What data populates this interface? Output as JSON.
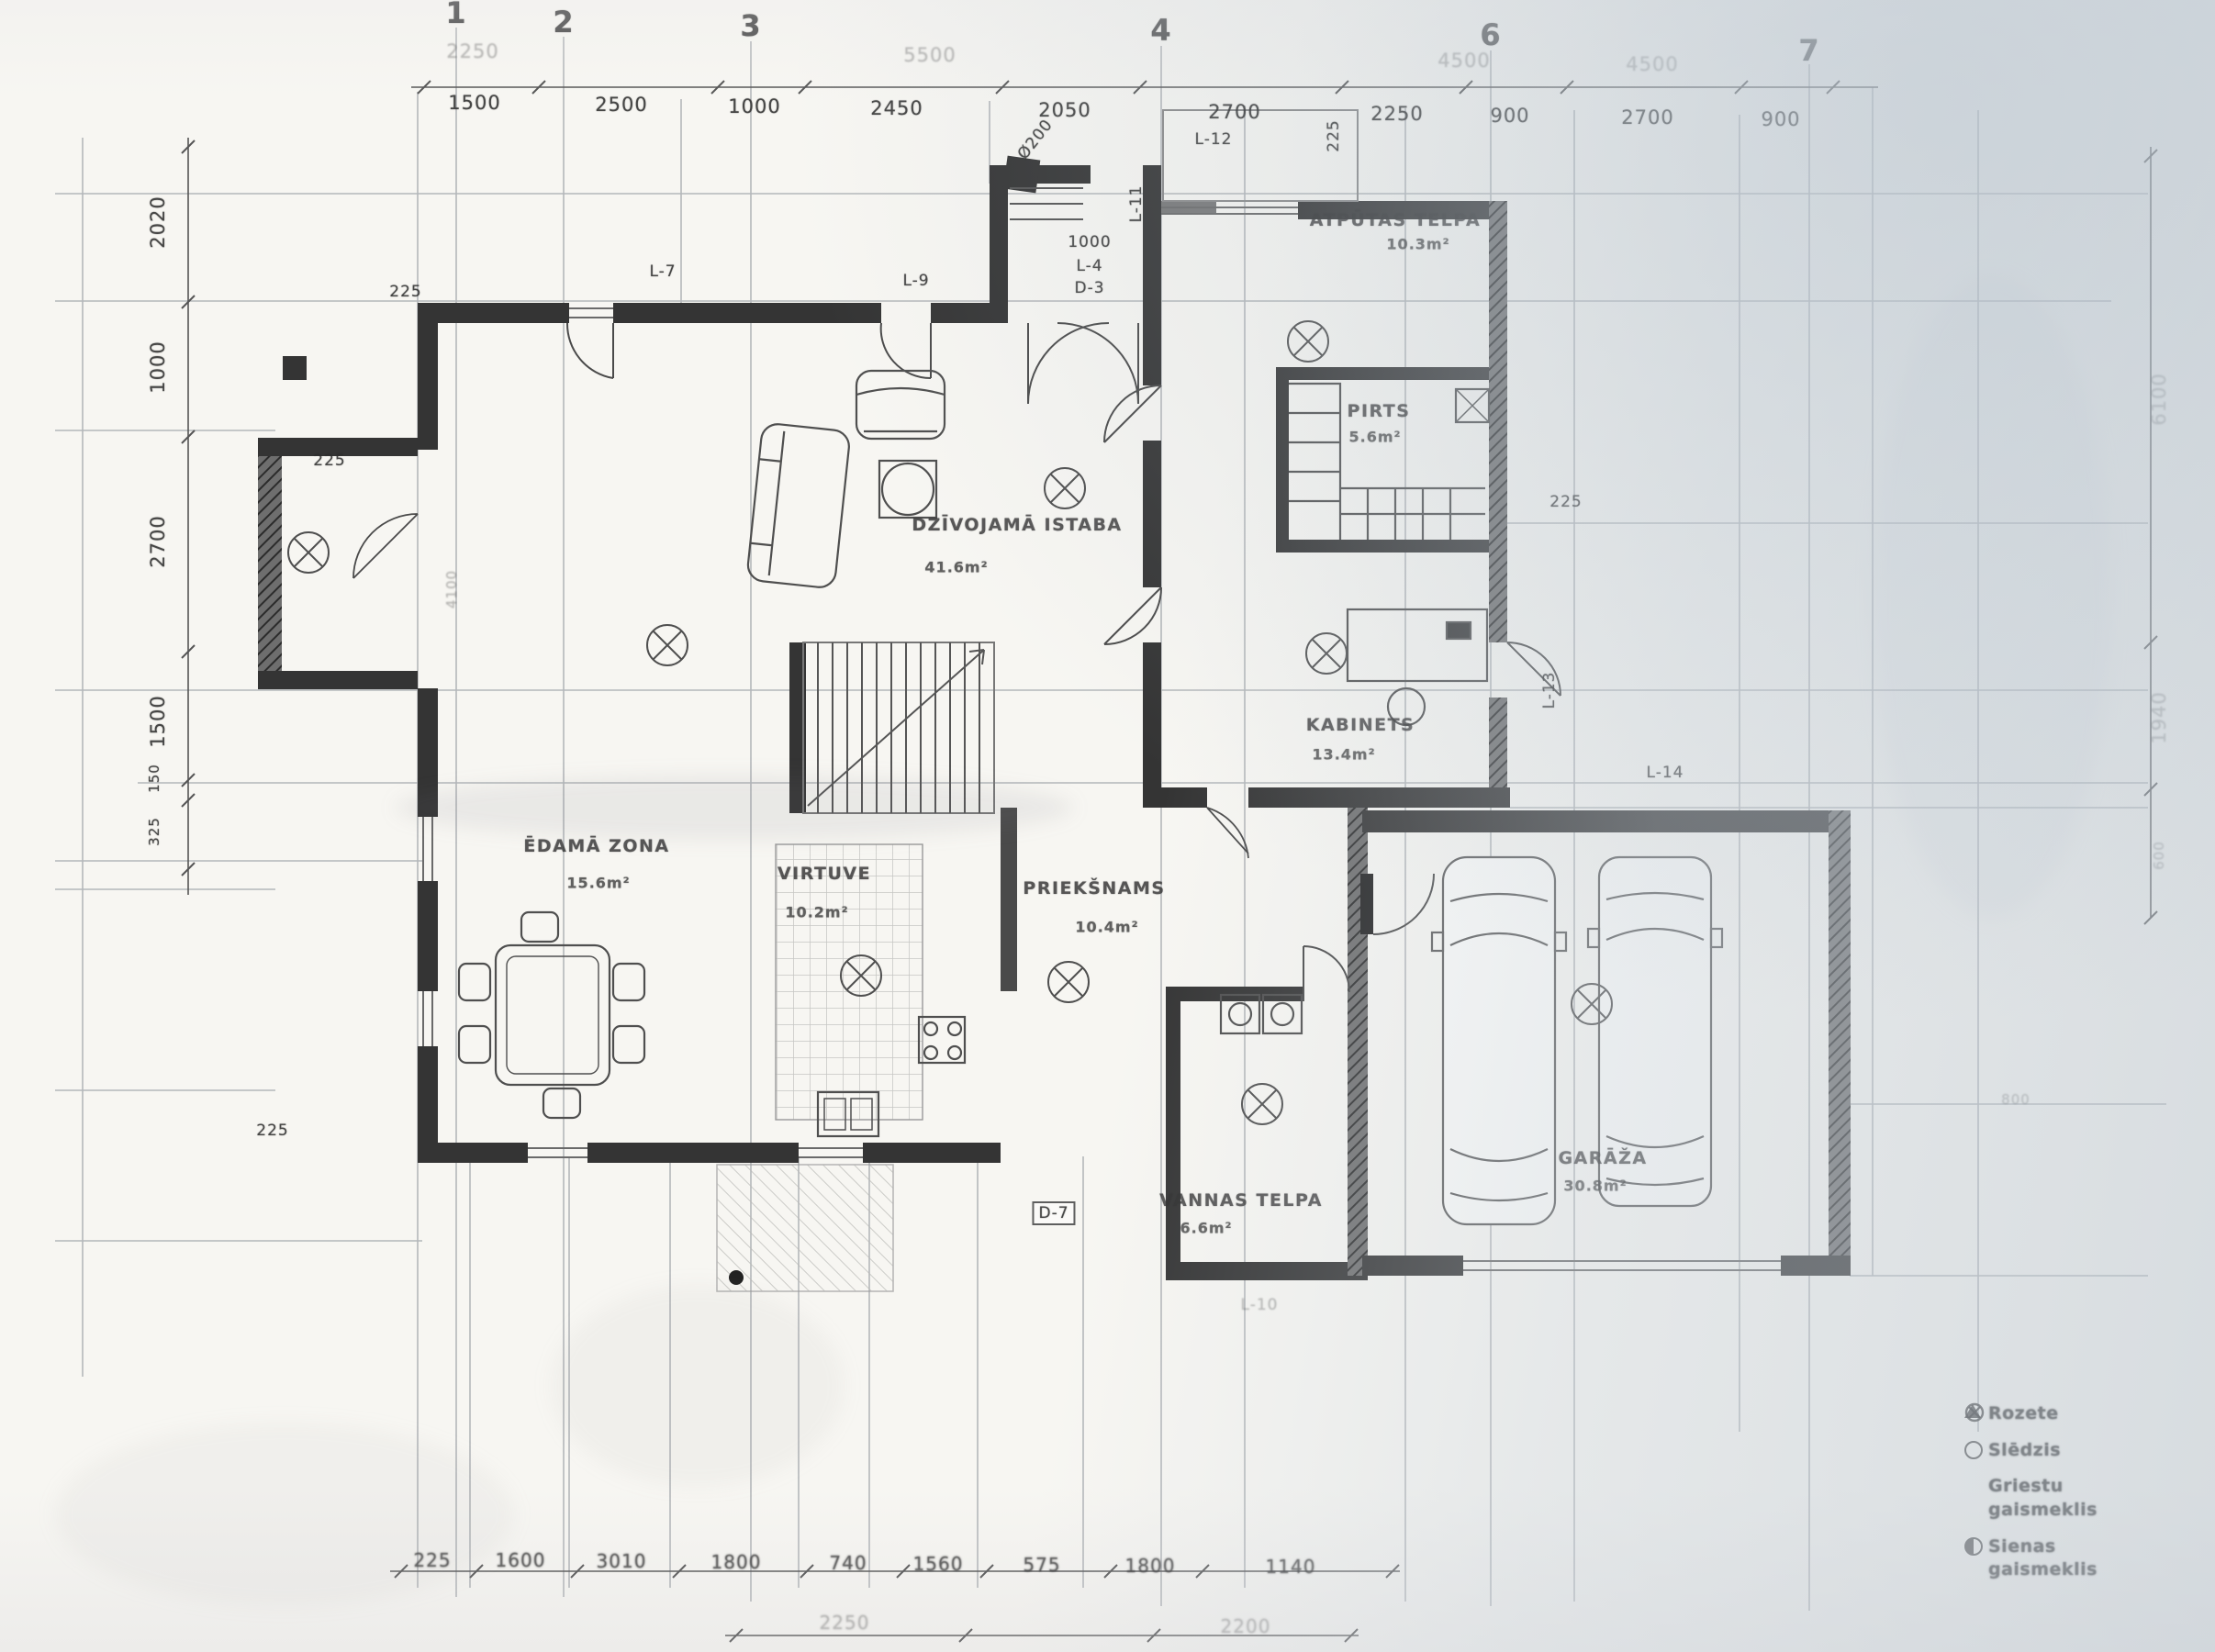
{
  "document": {
    "kind": "scanned architectural floor plan"
  },
  "grid_columns": [
    "1",
    "2",
    "3",
    "4",
    "6",
    "7"
  ],
  "dims": {
    "top_faint": [
      "2250",
      "5500",
      "4500",
      "4500"
    ],
    "top": [
      "1500",
      "2500",
      "1000",
      "2450",
      "2050",
      "2700",
      "2250",
      "900",
      "2700",
      "900"
    ],
    "left": [
      "2020",
      "1000",
      "2700",
      "1500",
      "150",
      "325"
    ],
    "right": [
      "6100",
      "1940",
      "600",
      "800"
    ],
    "bottom": [
      "225",
      "1600",
      "3010",
      "1800",
      "740",
      "1560",
      "575",
      "1800",
      "1140"
    ],
    "bottom_lower": [
      "2250",
      "2200"
    ],
    "thickness": [
      "225",
      "225",
      "225",
      "225",
      "225"
    ],
    "misc": {
      "flue": "Ø200",
      "entry_width": "1000",
      "bay": "4100"
    }
  },
  "rooms": {
    "atputas": {
      "name": "ATPŪTAS TELPA",
      "area": "10.3m²"
    },
    "pirts": {
      "name": "PIRTS",
      "area": "5.6m²"
    },
    "dzivojama": {
      "name": "DZĪVOJAMĀ ISTABA",
      "area": "41.6m²"
    },
    "kabinets": {
      "name": "KABINETS",
      "area": "13.4m²"
    },
    "edama": {
      "name": "ĒDAMĀ ZONA",
      "area": "15.6m²"
    },
    "virtuve": {
      "name": "VIRTUVE",
      "area": "10.2m²"
    },
    "prieksnams": {
      "name": "PRIEKŠNAMS",
      "area": "10.4m²"
    },
    "vannas": {
      "name": "VANNAS TELPA",
      "area": "6.6m²"
    },
    "garaza": {
      "name": "GARĀŽA",
      "area": "30.8m²"
    }
  },
  "openings": {
    "l12": "L-12",
    "l11": "L-11",
    "l7": "L-7",
    "l9": "L-9",
    "l4": "L-4",
    "d3": "D-3",
    "l13": "L-13",
    "l14": "L-14",
    "l10": "L-10",
    "d7": "D-7"
  },
  "legend": {
    "items": [
      {
        "symbol": "triangle",
        "label": "Rozete"
      },
      {
        "symbol": "circle",
        "label": "Slēdzis"
      },
      {
        "symbol": "circle-x",
        "label": "Griestu gaismeklis"
      },
      {
        "symbol": "circle-half",
        "label": "Sienas gaismeklis"
      }
    ]
  }
}
